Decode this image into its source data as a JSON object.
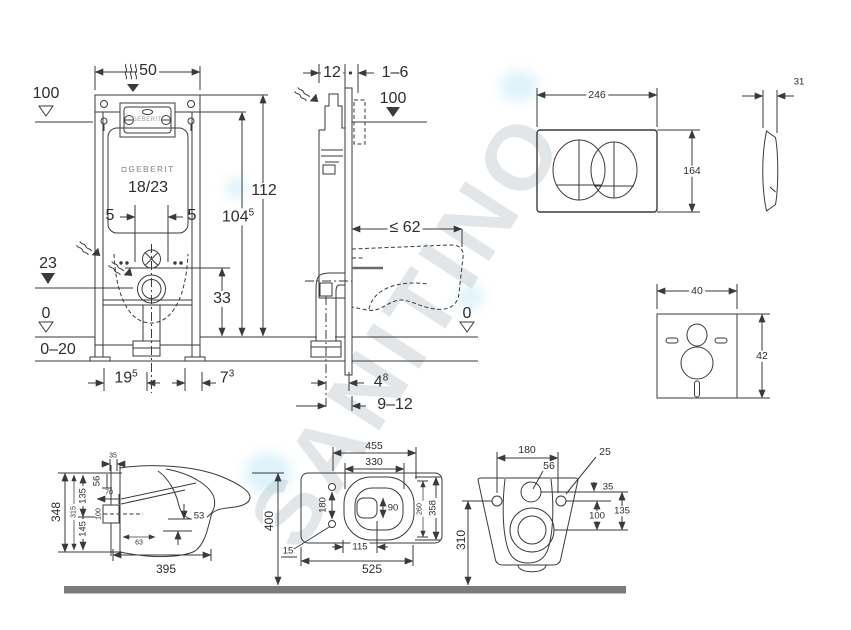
{
  "watermark": {
    "text": "SANITINO"
  },
  "frame_front": {
    "width_top": "50",
    "level_plate": "100",
    "height_frame": "112",
    "height_actuator": {
      "main": "104",
      "sup": "5"
    },
    "offset_flush_left": "5",
    "offset_flush_right": "5",
    "window_label": "GEBERIT",
    "brand": "GEBERIT",
    "cistern_model": "18/23",
    "level_outlet": "23",
    "outlet_to_floor": "33",
    "level_floor": "0",
    "floor_adjust": "0–20",
    "foot_span": {
      "main": "19",
      "sup": "5"
    },
    "foot_depth": {
      "main": "7",
      "sup": "3"
    }
  },
  "frame_side": {
    "cistern_depth": "12",
    "wall_gap": "1–6",
    "level_plate": "100",
    "max_depth": "≤ 62",
    "level_floor": "0",
    "outlet_offset": {
      "main": "4",
      "sup": "8"
    },
    "outlet_range": "9–12"
  },
  "flush_plate": {
    "width": "246",
    "height": "164",
    "depth": "31"
  },
  "insulation_pad": {
    "width": "40",
    "height": "42"
  },
  "wc_side": {
    "height_body": "348",
    "height_inner": "315",
    "upper_split": "135",
    "lower_split": "145",
    "rim_drop": "56",
    "top_inset": "35",
    "spout_len": "70",
    "inlet_size": "100",
    "drop": "53",
    "trap_inset": "63",
    "depth_body": "395",
    "height_floor": "400"
  },
  "wc_top": {
    "depth_rim": "455",
    "bowl_depth": "330",
    "hole_spacing": "180",
    "drain_width": "90",
    "drain_offset": "115",
    "depth_total": "525",
    "hole_inset": "15",
    "width_inner": "260",
    "width_outer": "358"
  },
  "wc_front": {
    "hole_spacing": "180",
    "side_hole": "25",
    "center_hole": "56",
    "row_gap": "35",
    "drain_drop": "100",
    "total_drop": "135",
    "mount_height": "310"
  }
}
